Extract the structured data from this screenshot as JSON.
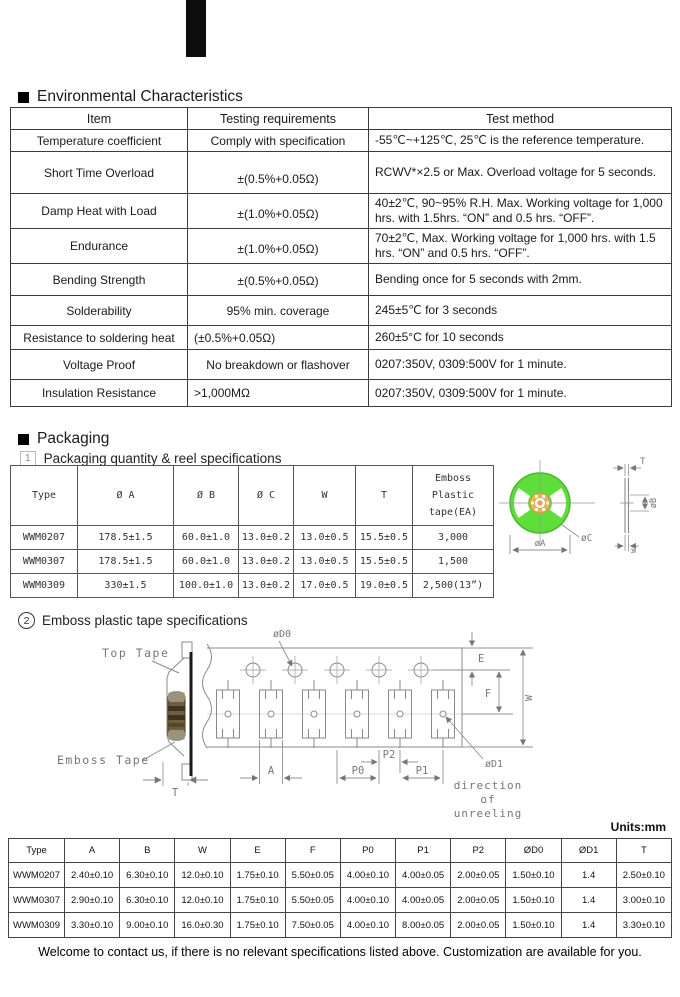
{
  "env": {
    "bullet": "■",
    "title": "Environmental Characteristics",
    "headers": [
      "Item",
      "Testing requirements",
      "Test method"
    ],
    "rows": [
      {
        "item": "Temperature coefficient",
        "req": "Comply with specification",
        "method": "-55℃~+125℃, 25℃ is the reference temperature."
      },
      {
        "item": "Short Time Overload",
        "req": "±(0.5%+0.05Ω)",
        "method": "RCWV*×2.5 or Max. Overload voltage for 5 seconds."
      },
      {
        "item": "Damp Heat with Load",
        "req": "±(1.0%+0.05Ω)",
        "method": "40±2℃, 90~95% R.H. Max. Working voltage for 1,000 hrs. with 1.5hrs. “ON” and 0.5 hrs. “OFF”."
      },
      {
        "item": "Endurance",
        "req": "±(1.0%+0.05Ω)",
        "method": "70±2℃, Max. Working voltage for 1,000 hrs. with 1.5 hrs. “ON” and 0.5 hrs. “OFF”."
      },
      {
        "item": "Bending Strength",
        "req": "±(0.5%+0.05Ω)",
        "method": "Bending once for 5 seconds with 2mm."
      },
      {
        "item": "Solderability",
        "req": "95% min. coverage",
        "method": "245±5℃   for 3 seconds"
      },
      {
        "item": "Resistance to soldering heat",
        "req": "(±0.5%+0.05Ω)",
        "method": "260±5°C for 10 seconds"
      },
      {
        "item": "Voltage Proof",
        "req": "No breakdown or flashover",
        "method": "0207:350V, 0309:500V for 1 minute."
      },
      {
        "item": "Insulation Resistance",
        "req": ">1,000MΩ",
        "method": "0207:350V, 0309:500V for 1 minute."
      }
    ]
  },
  "packaging": {
    "bullet": "■",
    "title": "Packaging",
    "sub1_num": "1",
    "sub1": "Packaging quantity & reel specifications",
    "sub2_num": "2",
    "sub2": "Emboss plastic tape specifications",
    "reel_table": {
      "headers": [
        "Type",
        "Ø A",
        "Ø B",
        "Ø C",
        "W",
        "T",
        "Emboss Plastic tape(EA)"
      ],
      "rows": [
        [
          "WWM0207",
          "178.5±1.5",
          "60.0±1.0",
          "13.0±0.2",
          "13.0±0.5",
          "15.5±0.5",
          "3,000"
        ],
        [
          "WWM0307",
          "178.5±1.5",
          "60.0±1.0",
          "13.0±0.2",
          "13.0±0.5",
          "15.5±0.5",
          "1,500"
        ],
        [
          "WWM0309",
          "330±1.5",
          "100.0±1.0",
          "13.0±0.2",
          "17.0±0.5",
          "19.0±0.5",
          "2,500(13”)"
        ]
      ]
    }
  },
  "reel_diagram": {
    "dim_a": "øA",
    "dim_c": "øC",
    "dim_t": "T",
    "dim_b": "øB",
    "dim_w": "W",
    "reel_green": "#5fdd3b",
    "hub_orange": "#eab257"
  },
  "tape_diagram": {
    "top_tape": "Top Tape",
    "emboss_tape": "Emboss Tape",
    "dim_t": "T",
    "dim_d0": "øD0",
    "dim_d1": "øD1",
    "dim_a": "A",
    "dim_p0": "P0",
    "dim_p1": "P1",
    "dim_p2": "P2",
    "dim_e": "E",
    "dim_f": "F",
    "dim_w": "W",
    "unreel_1": "direction",
    "unreel_2": "of",
    "unreel_3": "unreeling"
  },
  "units_note": "Units:mm",
  "tape_table": {
    "headers": [
      "Type",
      "A",
      "B",
      "W",
      "E",
      "F",
      "P0",
      "P1",
      "P2",
      "ØD0",
      "ØD1",
      "T"
    ],
    "rows": [
      [
        "WWM0207",
        "2.40±0.10",
        "6.30±0.10",
        "12.0±0.10",
        "1.75±0.10",
        "5.50±0.05",
        "4.00±0.10",
        "4.00±0.05",
        "2.00±0.05",
        "1.50±0.10",
        "1.4",
        "2.50±0.10"
      ],
      [
        "WWM0307",
        "2.90±0.10",
        "6.30±0.10",
        "12.0±0.10",
        "1.75±0.10",
        "5.50±0.05",
        "4.00±0.10",
        "4.00±0.05",
        "2.00±0.05",
        "1.50±0.10",
        "1.4",
        "3.00±0.10"
      ],
      [
        "WWM0309",
        "3.30±0.10",
        "9.00±0.10",
        "16.0±0.30",
        "1.75±0.10",
        "7.50±0.05",
        "4.00±0.10",
        "8.00±0.05",
        "2.00±0.05",
        "1.50±0.10",
        "1.4",
        "3.30±0.10"
      ]
    ]
  },
  "footer": "Welcome to contact us, if there is no relevant specifications listed above. Customization are available for you."
}
